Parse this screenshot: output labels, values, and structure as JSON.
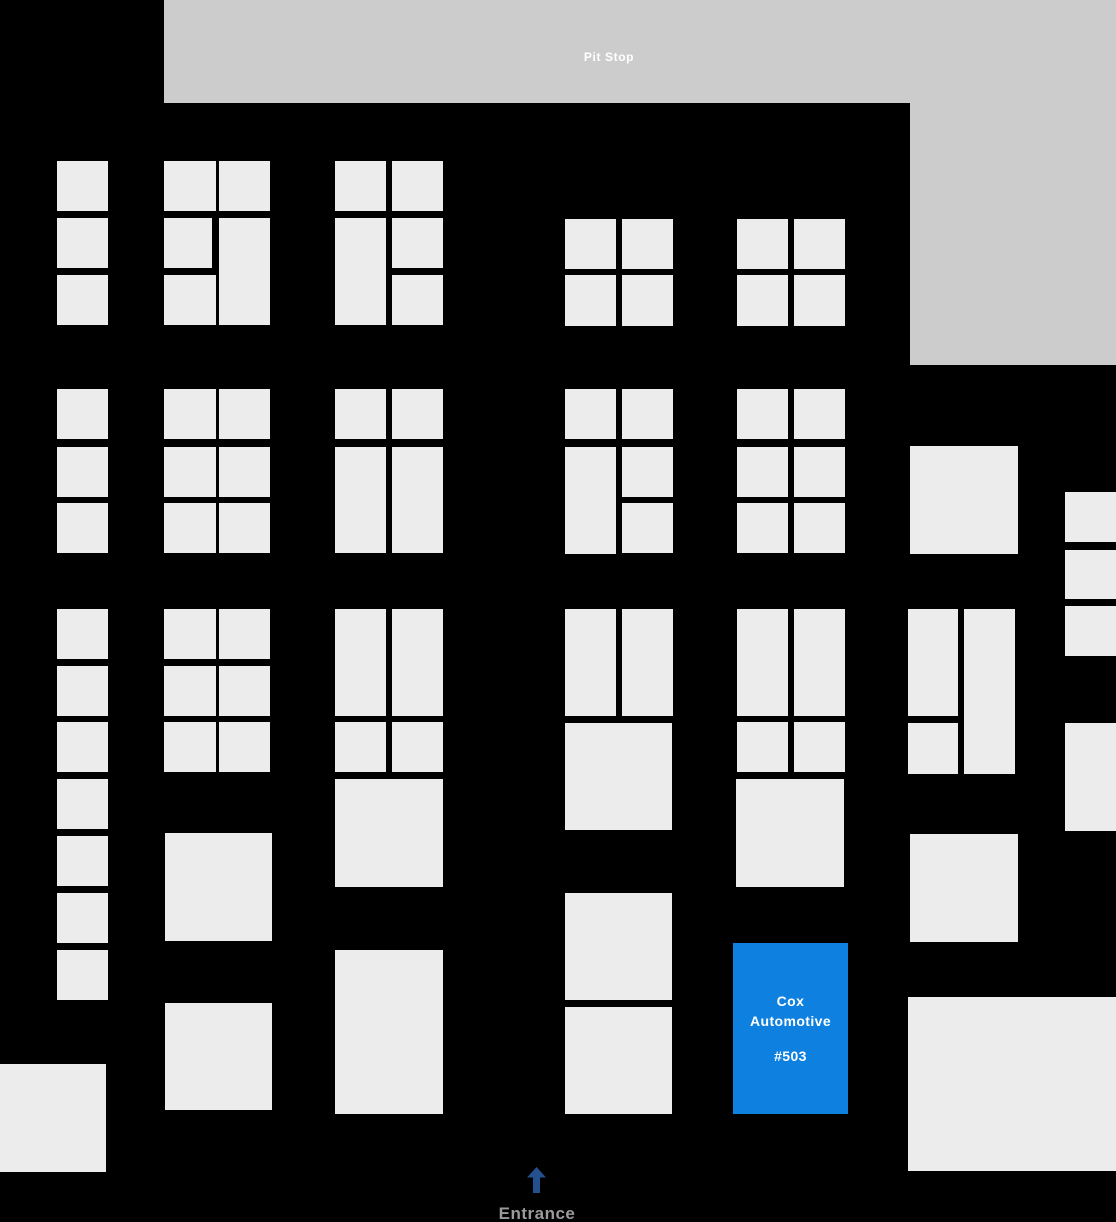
{
  "labels": {
    "pit_stop": "Pit Stop",
    "entrance": "Entrance"
  },
  "cox": {
    "name": "Cox Automotive",
    "number": "#503",
    "rect": {
      "x": 733,
      "y": 943,
      "w": 115,
      "h": 171
    }
  },
  "colors": {
    "background": "#000000",
    "booth": "#ececec",
    "zone": "#cccccc",
    "highlight": "#0d80e0",
    "highlight_text": "#ffffff",
    "banner_text": "#ffffff",
    "arrow": "#24508f",
    "entrance_text": "#9a9a9a"
  },
  "zones": [
    {
      "name": "pit-stop-banner",
      "x": 164,
      "y": 0,
      "w": 952,
      "h": 103
    },
    {
      "name": "pit-stop-right-block",
      "x": 910,
      "y": 103,
      "w": 206,
      "h": 262
    }
  ],
  "booths": [
    {
      "x": 57,
      "y": 161,
      "w": 51,
      "h": 50
    },
    {
      "x": 57,
      "y": 218,
      "w": 51,
      "h": 50
    },
    {
      "x": 57,
      "y": 275,
      "w": 51,
      "h": 50
    },
    {
      "x": 57,
      "y": 389,
      "w": 51,
      "h": 50
    },
    {
      "x": 57,
      "y": 447,
      "w": 51,
      "h": 50
    },
    {
      "x": 57,
      "y": 503,
      "w": 51,
      "h": 50
    },
    {
      "x": 57,
      "y": 609,
      "w": 51,
      "h": 50
    },
    {
      "x": 57,
      "y": 666,
      "w": 51,
      "h": 50
    },
    {
      "x": 57,
      "y": 722,
      "w": 51,
      "h": 50
    },
    {
      "x": 57,
      "y": 779,
      "w": 51,
      "h": 50
    },
    {
      "x": 57,
      "y": 836,
      "w": 51,
      "h": 50
    },
    {
      "x": 57,
      "y": 893,
      "w": 51,
      "h": 50
    },
    {
      "x": 57,
      "y": 950,
      "w": 51,
      "h": 50
    },
    {
      "x": 164,
      "y": 161,
      "w": 52,
      "h": 50
    },
    {
      "x": 219,
      "y": 161,
      "w": 51,
      "h": 50
    },
    {
      "x": 164,
      "y": 218,
      "w": 48,
      "h": 50
    },
    {
      "x": 219,
      "y": 218,
      "w": 51,
      "h": 107
    },
    {
      "x": 164,
      "y": 275,
      "w": 52,
      "h": 50
    },
    {
      "x": 164,
      "y": 389,
      "w": 52,
      "h": 50
    },
    {
      "x": 219,
      "y": 389,
      "w": 51,
      "h": 50
    },
    {
      "x": 164,
      "y": 447,
      "w": 52,
      "h": 50
    },
    {
      "x": 219,
      "y": 447,
      "w": 51,
      "h": 50
    },
    {
      "x": 164,
      "y": 503,
      "w": 52,
      "h": 50
    },
    {
      "x": 219,
      "y": 503,
      "w": 51,
      "h": 50
    },
    {
      "x": 164,
      "y": 609,
      "w": 52,
      "h": 50
    },
    {
      "x": 219,
      "y": 609,
      "w": 51,
      "h": 50
    },
    {
      "x": 164,
      "y": 666,
      "w": 52,
      "h": 50
    },
    {
      "x": 219,
      "y": 666,
      "w": 51,
      "h": 50
    },
    {
      "x": 164,
      "y": 722,
      "w": 52,
      "h": 50
    },
    {
      "x": 219,
      "y": 722,
      "w": 51,
      "h": 50
    },
    {
      "x": 165,
      "y": 833,
      "w": 107,
      "h": 108
    },
    {
      "x": 165,
      "y": 1003,
      "w": 107,
      "h": 107
    },
    {
      "x": 335,
      "y": 161,
      "w": 51,
      "h": 50
    },
    {
      "x": 392,
      "y": 161,
      "w": 51,
      "h": 50
    },
    {
      "x": 335,
      "y": 218,
      "w": 51,
      "h": 107
    },
    {
      "x": 392,
      "y": 218,
      "w": 51,
      "h": 50
    },
    {
      "x": 392,
      "y": 275,
      "w": 51,
      "h": 50
    },
    {
      "x": 335,
      "y": 389,
      "w": 51,
      "h": 50
    },
    {
      "x": 392,
      "y": 389,
      "w": 51,
      "h": 50
    },
    {
      "x": 335,
      "y": 447,
      "w": 51,
      "h": 106
    },
    {
      "x": 392,
      "y": 447,
      "w": 51,
      "h": 106
    },
    {
      "x": 335,
      "y": 609,
      "w": 51,
      "h": 107
    },
    {
      "x": 392,
      "y": 609,
      "w": 51,
      "h": 107
    },
    {
      "x": 335,
      "y": 722,
      "w": 51,
      "h": 50
    },
    {
      "x": 392,
      "y": 722,
      "w": 51,
      "h": 50
    },
    {
      "x": 335,
      "y": 779,
      "w": 108,
      "h": 108
    },
    {
      "x": 335,
      "y": 950,
      "w": 108,
      "h": 164
    },
    {
      "x": 565,
      "y": 219,
      "w": 51,
      "h": 50
    },
    {
      "x": 622,
      "y": 219,
      "w": 51,
      "h": 50
    },
    {
      "x": 565,
      "y": 275,
      "w": 51,
      "h": 51
    },
    {
      "x": 622,
      "y": 275,
      "w": 51,
      "h": 51
    },
    {
      "x": 565,
      "y": 389,
      "w": 51,
      "h": 50
    },
    {
      "x": 622,
      "y": 389,
      "w": 51,
      "h": 50
    },
    {
      "x": 565,
      "y": 447,
      "w": 51,
      "h": 107
    },
    {
      "x": 622,
      "y": 447,
      "w": 51,
      "h": 50
    },
    {
      "x": 622,
      "y": 503,
      "w": 51,
      "h": 50
    },
    {
      "x": 565,
      "y": 609,
      "w": 51,
      "h": 107
    },
    {
      "x": 622,
      "y": 609,
      "w": 51,
      "h": 107
    },
    {
      "x": 565,
      "y": 723,
      "w": 107,
      "h": 107
    },
    {
      "x": 565,
      "y": 893,
      "w": 107,
      "h": 107
    },
    {
      "x": 565,
      "y": 1007,
      "w": 107,
      "h": 107
    },
    {
      "x": 737,
      "y": 219,
      "w": 51,
      "h": 50
    },
    {
      "x": 794,
      "y": 219,
      "w": 51,
      "h": 50
    },
    {
      "x": 737,
      "y": 275,
      "w": 51,
      "h": 51
    },
    {
      "x": 794,
      "y": 275,
      "w": 51,
      "h": 51
    },
    {
      "x": 737,
      "y": 389,
      "w": 51,
      "h": 50
    },
    {
      "x": 794,
      "y": 389,
      "w": 51,
      "h": 50
    },
    {
      "x": 737,
      "y": 447,
      "w": 51,
      "h": 50
    },
    {
      "x": 794,
      "y": 447,
      "w": 51,
      "h": 50
    },
    {
      "x": 737,
      "y": 503,
      "w": 51,
      "h": 50
    },
    {
      "x": 794,
      "y": 503,
      "w": 51,
      "h": 50
    },
    {
      "x": 737,
      "y": 609,
      "w": 51,
      "h": 107
    },
    {
      "x": 794,
      "y": 609,
      "w": 51,
      "h": 107
    },
    {
      "x": 737,
      "y": 722,
      "w": 51,
      "h": 50
    },
    {
      "x": 794,
      "y": 722,
      "w": 51,
      "h": 50
    },
    {
      "x": 736,
      "y": 779,
      "w": 108,
      "h": 108
    },
    {
      "x": 910,
      "y": 446,
      "w": 108,
      "h": 108
    },
    {
      "x": 908,
      "y": 609,
      "w": 50,
      "h": 107
    },
    {
      "x": 964,
      "y": 609,
      "w": 51,
      "h": 165
    },
    {
      "x": 908,
      "y": 723,
      "w": 50,
      "h": 51
    },
    {
      "x": 910,
      "y": 834,
      "w": 108,
      "h": 108
    },
    {
      "x": 908,
      "y": 997,
      "w": 208,
      "h": 174
    },
    {
      "x": 1065,
      "y": 492,
      "w": 51,
      "h": 50
    },
    {
      "x": 1065,
      "y": 550,
      "w": 51,
      "h": 49
    },
    {
      "x": 1065,
      "y": 606,
      "w": 51,
      "h": 50
    },
    {
      "x": 1065,
      "y": 723,
      "w": 51,
      "h": 108
    },
    {
      "x": 0,
      "y": 1064,
      "w": 106,
      "h": 108
    }
  ]
}
